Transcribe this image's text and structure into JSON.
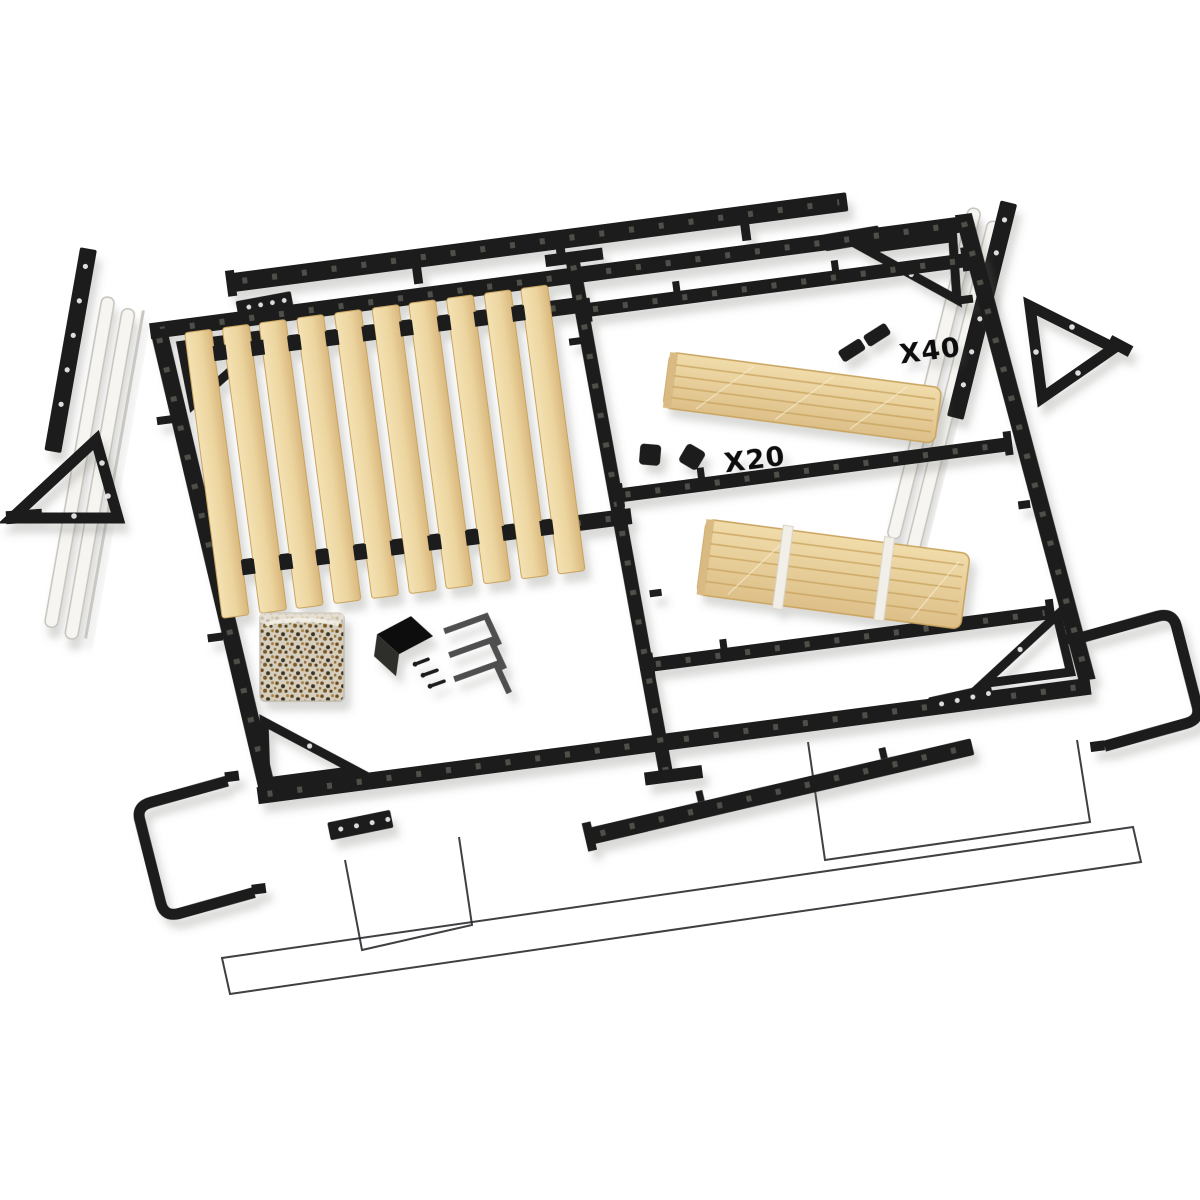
{
  "scene": {
    "type": "product-photo",
    "subject": "wall-bed frame hardware kit, exploded view",
    "background": "#ffffff",
    "labels": {
      "cap_count_top": "X40",
      "cap_count_middle": "X20"
    },
    "counts": {
      "visible_slats": 10,
      "slat_bundles": 2,
      "hex_keys": 3,
      "triangle_wall_brackets": 2,
      "u_shaped_legs": 2
    },
    "colors": {
      "metal": "#1d1d1b",
      "metal_hole": "#56564f",
      "wood_light": "#f4e2b4",
      "wood_mid": "#ecd49e",
      "wood_dark": "#d9b87e",
      "wood_line": "#c9a45f",
      "piston": "#f6f5f1",
      "piston_stroke": "#c6c3bc",
      "strap": "#f2efe8",
      "bag_base": "#d6cfbf",
      "screw_brown": "#7c5a28",
      "hex_key_gray": "#4f4f4f",
      "outline": "#26262a",
      "shadow": "#6a6a64"
    }
  }
}
